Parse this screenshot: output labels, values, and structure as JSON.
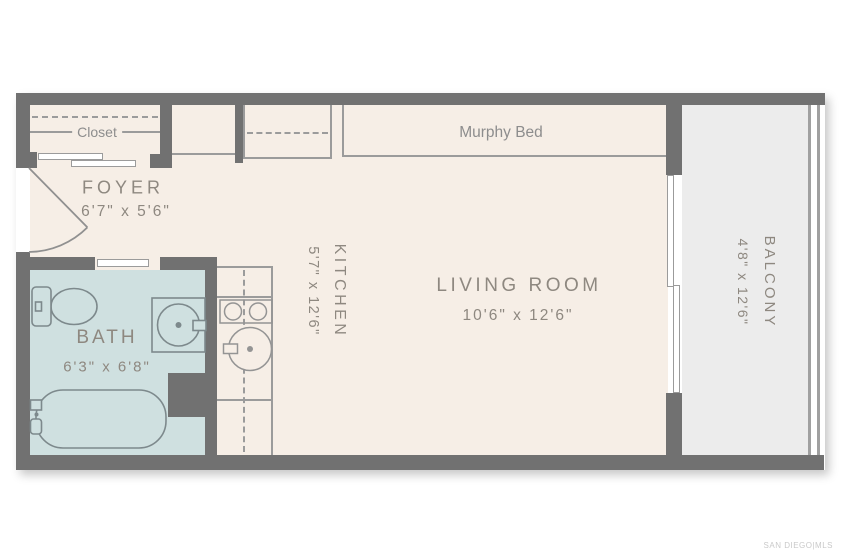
{
  "watermark": "SAN DIEGO|MLS",
  "labels": {
    "closet": "Closet",
    "murphy_bed": "Murphy Bed",
    "foyer": {
      "name": "FOYER",
      "dims": "6'7\" x 5'6\""
    },
    "bath": {
      "name": "BATH",
      "dims": "6'3\" x 6'8\""
    },
    "kitchen": {
      "name": "KITCHEN",
      "dims": "5'7\" x 12'6\""
    },
    "living_room": {
      "name": "LIVING ROOM",
      "dims": "10'6\" x 12'6\""
    },
    "balcony": {
      "name": "BALCONY",
      "dims": "4'8\" x 12'6\""
    }
  },
  "colors": {
    "wall": "#717171",
    "interior_floor": "#f6eee6",
    "bath_floor": "#cfe0e0",
    "balcony_floor": "#ececec",
    "thin_line": "#9b9b9b",
    "room_label_text": "#8e8880",
    "feature_label_text": "#8d8d8d",
    "bath_fixture_line": "#7d898c",
    "kitchen_fixture_line": "#949494"
  },
  "fixtures": [
    "entry-door",
    "closet-sliding-doors",
    "closet-shelf",
    "bathroom-pocket-door",
    "toilet",
    "bathroom-sink",
    "bathtub",
    "kitchen-counter",
    "kitchen-cooktop",
    "kitchen-sink",
    "murphy-bed",
    "sliding-glass-door",
    "balcony-railing"
  ]
}
